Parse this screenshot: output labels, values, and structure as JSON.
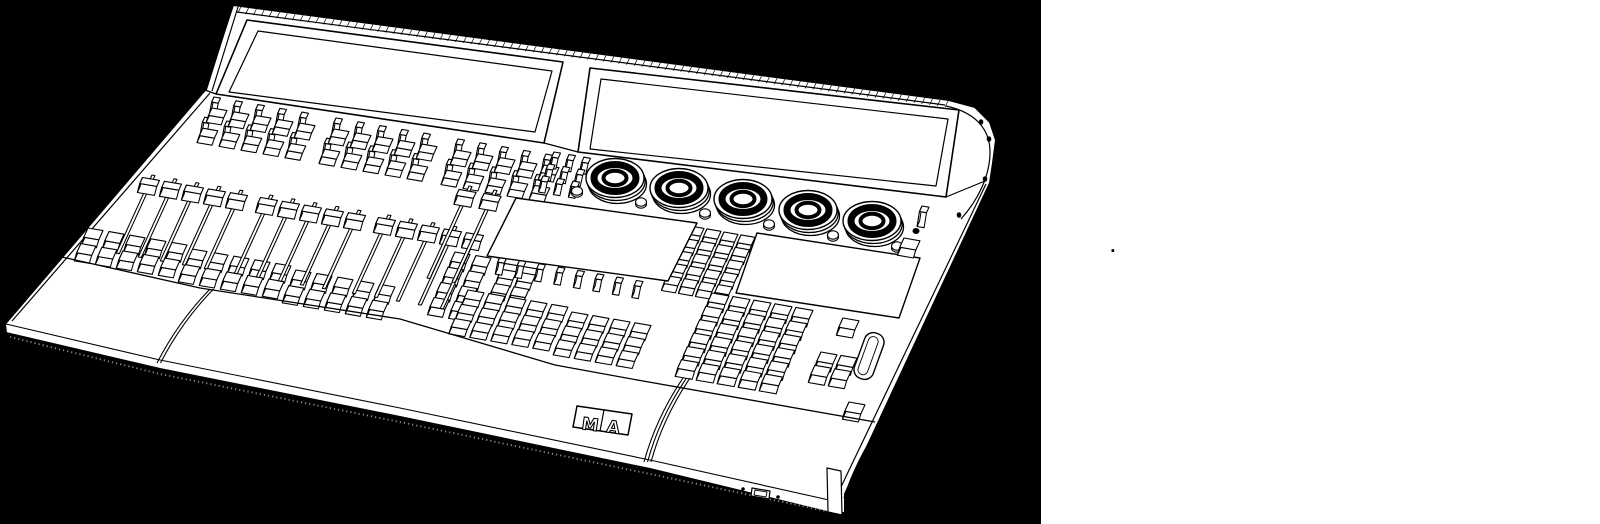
{
  "canvas": {
    "width": 1600,
    "height": 524,
    "page_bg": "#ffffff"
  },
  "panel": {
    "x": 0,
    "y": 0,
    "width": 1041,
    "height": 524,
    "bg": "#000000"
  },
  "caption": {
    "text": ".",
    "x": 1110,
    "y": 240
  },
  "console": {
    "description": "line-art-lighting-control-console",
    "logo_text": "MA",
    "colors": {
      "line": "#000000",
      "fill": "#ffffff",
      "speckle": "#8a8a8a"
    },
    "basis": {
      "u": [
        1,
        0.172
      ],
      "v": [
        -0.42,
        0.92
      ]
    },
    "silhouette": [
      [
        233,
        5
      ],
      [
        949,
        100
      ],
      [
        975,
        107
      ],
      [
        990,
        122
      ],
      [
        996,
        140
      ],
      [
        993,
        163
      ],
      [
        990,
        183
      ],
      [
        845,
        494
      ],
      [
        845,
        513
      ],
      [
        827,
        512
      ],
      [
        650,
        469
      ],
      [
        400,
        417
      ],
      [
        160,
        369
      ],
      [
        6,
        333
      ],
      [
        5,
        324
      ],
      [
        205,
        90
      ]
    ],
    "edges": {
      "lid_left_outer": [
        [
          233,
          5
        ],
        [
          206,
          91
        ]
      ],
      "lid_left_inner": [
        [
          238,
          7
        ],
        [
          212,
          91
        ]
      ],
      "deck_left_inner": [
        [
          210,
          93
        ],
        [
          12,
          321
        ]
      ],
      "deck_lid_joint": [
        [
          205,
          90
        ],
        [
          216,
          94
        ]
      ],
      "right_side_inner": [
        [
          986,
          184
        ],
        [
          840,
          489
        ]
      ],
      "gap_bottom": [
        [
          544,
          143
        ],
        [
          578,
          152
        ]
      ],
      "cap_joint": [
        [
          946,
          197
        ],
        [
          985,
          181
        ]
      ],
      "top_inner": [
        [
          237,
          12
        ],
        [
          945,
          105
        ]
      ]
    },
    "hatch_ticks": {
      "from": [
        233,
        6
      ],
      "to": [
        948,
        101
      ],
      "count": 92,
      "vec": [
        -3,
        6
      ]
    },
    "screens": [
      {
        "name": "left-screen",
        "outer": [
          [
            247,
            20
          ],
          [
            563,
            62
          ],
          [
            544,
            143
          ],
          [
            216,
            94
          ]
        ],
        "inner": [
          [
            258,
            31
          ],
          [
            552,
            71
          ],
          [
            535,
            132
          ],
          [
            229,
            92
          ]
        ]
      },
      {
        "name": "right-screen",
        "outer": [
          [
            590,
            68
          ],
          [
            959,
            110
          ],
          [
            946,
            197
          ],
          [
            578,
            152
          ]
        ],
        "inner": [
          [
            601,
            79
          ],
          [
            948,
            119
          ],
          [
            936,
            186
          ],
          [
            590,
            149
          ]
        ]
      }
    ],
    "end_cap": {
      "curve": "M946,106 C974,112 990,128 990,152 C990,176 978,200 961,219",
      "screws": [
        [
          981,
          122
        ],
        [
          989,
          139
        ],
        [
          985,
          179
        ],
        [
          959,
          215
        ]
      ]
    },
    "displays": [
      {
        "name": "center-display-left",
        "quad": [
          [
            516,
            198
          ],
          [
            697,
            223
          ],
          [
            668,
            281
          ],
          [
            487,
            256
          ]
        ]
      },
      {
        "name": "center-display-right",
        "quad": [
          [
            757,
            233
          ],
          [
            920,
            258
          ],
          [
            899,
            318
          ],
          [
            736,
            293
          ]
        ]
      }
    ],
    "knobs": [
      {
        "cx": 615,
        "cy": 178
      },
      {
        "cx": 679,
        "cy": 188
      },
      {
        "cx": 743,
        "cy": 199
      },
      {
        "cx": 808,
        "cy": 210
      },
      {
        "cx": 872,
        "cy": 221
      }
    ],
    "knob_style": {
      "rx": 29,
      "ry": 19.5,
      "ring_rx": 21,
      "ring_ry": 13.5,
      "ring_w": 7,
      "hole_rx": 11.5,
      "hole_ry": 7.2,
      "hole_w": 4
    },
    "dome_buttons": [
      [
        577,
        191
      ],
      [
        641,
        202
      ],
      [
        705,
        213
      ],
      [
        769,
        224
      ],
      [
        833,
        235
      ],
      [
        897,
        246
      ]
    ],
    "clusters": [
      {
        "name": "executor-stems-1",
        "o": [
          214,
          97
        ],
        "cols": 5,
        "rows": 2,
        "pitch": [
          22,
          22
        ],
        "key": [
          6.5,
          5.5
        ],
        "ext": 13,
        "style": "stem"
      },
      {
        "name": "executor-keys-1",
        "o": [
          212,
          108
        ],
        "cols": 5,
        "rows": 2,
        "pitch": [
          22,
          22
        ],
        "key": [
          15,
          8
        ],
        "ext": 7,
        "style": "key"
      },
      {
        "name": "executor-stems-2",
        "o": [
          336,
          118
        ],
        "cols": 5,
        "rows": 2,
        "pitch": [
          22,
          22
        ],
        "key": [
          6.5,
          5.5
        ],
        "ext": 13,
        "style": "stem"
      },
      {
        "name": "executor-keys-2",
        "o": [
          334,
          129
        ],
        "cols": 5,
        "rows": 2,
        "pitch": [
          22,
          22
        ],
        "key": [
          15,
          8
        ],
        "ext": 7,
        "style": "key"
      },
      {
        "name": "executor-stems-3",
        "o": [
          458,
          139
        ],
        "cols": 5,
        "rows": 2,
        "pitch": [
          22,
          22
        ],
        "key": [
          6.5,
          5.5
        ],
        "ext": 13,
        "style": "stem"
      },
      {
        "name": "executor-keys-3",
        "o": [
          456,
          150
        ],
        "cols": 5,
        "rows": 2,
        "pitch": [
          22,
          22
        ],
        "key": [
          15,
          8
        ],
        "ext": 7,
        "style": "key"
      },
      {
        "name": "gap-stems",
        "o": [
          554,
          152
        ],
        "cols": 3,
        "rows": 3,
        "pitch": [
          15,
          13
        ],
        "key": [
          6.5,
          5.5
        ],
        "ext": 11,
        "style": "stem"
      },
      {
        "name": "below-fader-keys-1",
        "o": [
          88,
          228
        ],
        "cols": 5,
        "rows": 2,
        "pitch": [
          21,
          17
        ],
        "key": [
          15,
          10
        ],
        "ext": 8,
        "style": "key"
      },
      {
        "name": "below-fader-keys-2",
        "o": [
          192,
          249
        ],
        "cols": 5,
        "rows": 2,
        "pitch": [
          21,
          17
        ],
        "key": [
          15,
          10
        ],
        "ext": 8,
        "style": "key"
      },
      {
        "name": "below-fader-keys-3",
        "o": [
          296,
          270
        ],
        "cols": 5,
        "rows": 2,
        "pitch": [
          21,
          17
        ],
        "key": [
          15,
          10
        ],
        "ext": 8,
        "style": "key"
      },
      {
        "name": "master-side-keys",
        "o": [
          455,
          252
        ],
        "cols": 2,
        "rows": 4,
        "pitch": [
          21,
          16.5
        ],
        "key": [
          15,
          10
        ],
        "ext": 8,
        "style": "key"
      },
      {
        "name": "right-stems",
        "o": [
          514,
          213
        ],
        "cols": 2,
        "rows": 3,
        "pitch": [
          17,
          15
        ],
        "key": [
          6.5,
          5.5
        ],
        "ext": 12,
        "style": "stem"
      },
      {
        "name": "right-stem-keys",
        "o": [
          508,
          255
        ],
        "cols": 2,
        "rows": 3,
        "pitch": [
          19,
          15.5
        ],
        "key": [
          15,
          9
        ],
        "ext": 7,
        "style": "key"
      },
      {
        "name": "under-display-stems",
        "o": [
          500,
          257
        ],
        "cols": 8,
        "rows": 1,
        "pitch": [
          19.5,
          0
        ],
        "key": [
          6.5,
          5.5
        ],
        "ext": 12,
        "style": "stem"
      },
      {
        "name": "center-keys-a",
        "o": [
          468,
          290
        ],
        "cols": 5,
        "rows": 3,
        "pitch": [
          21,
          15.5
        ],
        "key": [
          16,
          9
        ],
        "ext": 7,
        "style": "key"
      },
      {
        "name": "center-keys-b",
        "o": [
          572,
          312
        ],
        "cols": 4,
        "rows": 3,
        "pitch": [
          21,
          15
        ],
        "key": [
          16,
          9
        ],
        "ext": 7,
        "style": "key"
      },
      {
        "name": "command-col-a",
        "o": [
          690,
          226
        ],
        "cols": 2,
        "rows": 5,
        "pitch": [
          17,
          13.5
        ],
        "key": [
          14,
          8.5
        ],
        "ext": 7,
        "style": "key"
      },
      {
        "name": "command-col-b",
        "o": [
          724,
          232
        ],
        "cols": 2,
        "rows": 5,
        "pitch": [
          17,
          13.5
        ],
        "key": [
          14,
          8.5
        ],
        "ext": 7,
        "style": "key"
      },
      {
        "name": "numeric-keypad",
        "o": [
          712,
          293
        ],
        "cols": 5,
        "rows": 6,
        "pitch": [
          21,
          14.5
        ],
        "key": [
          17,
          9.5
        ],
        "ext": 8,
        "style": "key"
      },
      {
        "name": "right-single-1",
        "o": [
          843,
          318
        ],
        "cols": 1,
        "rows": 1,
        "pitch": [
          0,
          0
        ],
        "key": [
          16,
          10
        ],
        "ext": 8,
        "style": "key"
      },
      {
        "name": "right-2x2",
        "o": [
          821,
          352
        ],
        "cols": 2,
        "rows": 2,
        "pitch": [
          20,
          14.5
        ],
        "key": [
          16,
          10
        ],
        "ext": 8,
        "style": "key"
      },
      {
        "name": "right-single-2",
        "o": [
          849,
          402
        ],
        "cols": 1,
        "rows": 1,
        "pitch": [
          0,
          0
        ],
        "key": [
          16,
          10
        ],
        "ext": 8,
        "style": "key"
      },
      {
        "name": "menu-stick",
        "o": [
          922,
          206
        ],
        "cols": 1,
        "rows": 1,
        "pitch": [
          0,
          0
        ],
        "key": [
          7,
          6
        ],
        "ext": 15,
        "style": "stem"
      }
    ],
    "faders": [
      {
        "x": 152,
        "y": 175,
        "len": 85
      },
      {
        "x": 174,
        "y": 178.8,
        "len": 85
      },
      {
        "x": 196,
        "y": 182.6,
        "len": 85
      },
      {
        "x": 218,
        "y": 186.4,
        "len": 85
      },
      {
        "x": 240,
        "y": 190.2,
        "len": 85
      },
      {
        "x": 270,
        "y": 195,
        "len": 85
      },
      {
        "x": 292,
        "y": 198.8,
        "len": 85
      },
      {
        "x": 314,
        "y": 202.6,
        "len": 85
      },
      {
        "x": 336,
        "y": 206.4,
        "len": 85
      },
      {
        "x": 358,
        "y": 210.2,
        "len": 85
      },
      {
        "x": 388,
        "y": 215,
        "len": 85
      },
      {
        "x": 410,
        "y": 218.8,
        "len": 85
      },
      {
        "x": 432,
        "y": 222.6,
        "len": 85
      },
      {
        "x": 454,
        "y": 226.4,
        "len": 85
      },
      {
        "x": 476,
        "y": 230.2,
        "len": 85
      },
      {
        "x": 469,
        "y": 186,
        "len": 100
      },
      {
        "x": 494,
        "y": 190,
        "len": 100
      }
    ],
    "fader_cap_t": 0.07,
    "wheel": {
      "cx": 869,
      "cy": 356,
      "w": 20,
      "h": 48,
      "rot": 20
    },
    "power": {
      "key": [
        904,
        238
      ],
      "led": [
        916,
        231
      ],
      "led_r": 3.5
    },
    "armrest": {
      "boundary": [
        [
          62,
          257
        ],
        [
          200,
          288
        ],
        [
          400,
          319
        ],
        [
          555,
          365
        ],
        [
          643,
          381
        ],
        [
          875,
          422
        ]
      ],
      "front_edge": [
        [
          6,
          324
        ],
        [
          160,
          360
        ],
        [
          400,
          408
        ],
        [
          650,
          460
        ],
        [
          838,
          502
        ]
      ],
      "speckle": [
        [
          10,
          337
        ],
        [
          160,
          374
        ],
        [
          400,
          422
        ],
        [
          650,
          474
        ],
        [
          840,
          514
        ]
      ],
      "seams": [
        {
          "p": [
            [
              210,
              289
            ],
            [
              178,
              322
            ],
            [
              157,
              363
            ]
          ],
          "lines": 2
        },
        {
          "p": [
            [
              683,
              378
            ],
            [
              656,
              418
            ],
            [
              644,
              462
            ]
          ],
          "lines": 3
        },
        {
          "p": [
            [
              881,
              424
            ],
            [
              856,
              460
            ],
            [
              844,
              498
            ]
          ],
          "lines": 2
        }
      ],
      "corner_foot": [
        [
          827,
          468
        ],
        [
          841,
          471
        ],
        [
          842,
          515
        ],
        [
          828,
          512
        ]
      ]
    },
    "usb": {
      "outer": [
        [
          752,
          488
        ],
        [
          770,
          491
        ],
        [
          769,
          499
        ],
        [
          751,
          496
        ]
      ],
      "inner": [
        [
          755,
          490
        ],
        [
          767,
          492
        ],
        [
          766,
          497
        ],
        [
          754,
          495
        ]
      ],
      "screws": [
        [
          743,
          489
        ],
        [
          778,
          497
        ]
      ]
    },
    "logo": {
      "box": [
        [
          577,
          406
        ],
        [
          632,
          414
        ],
        [
          628,
          435
        ],
        [
          573,
          427
        ]
      ],
      "divider": [
        [
          604,
          410
        ],
        [
          600,
          431
        ]
      ],
      "m_pos": [
        581,
        429
      ],
      "a_pos": [
        606,
        432
      ],
      "rot": 8,
      "size": 17
    }
  }
}
